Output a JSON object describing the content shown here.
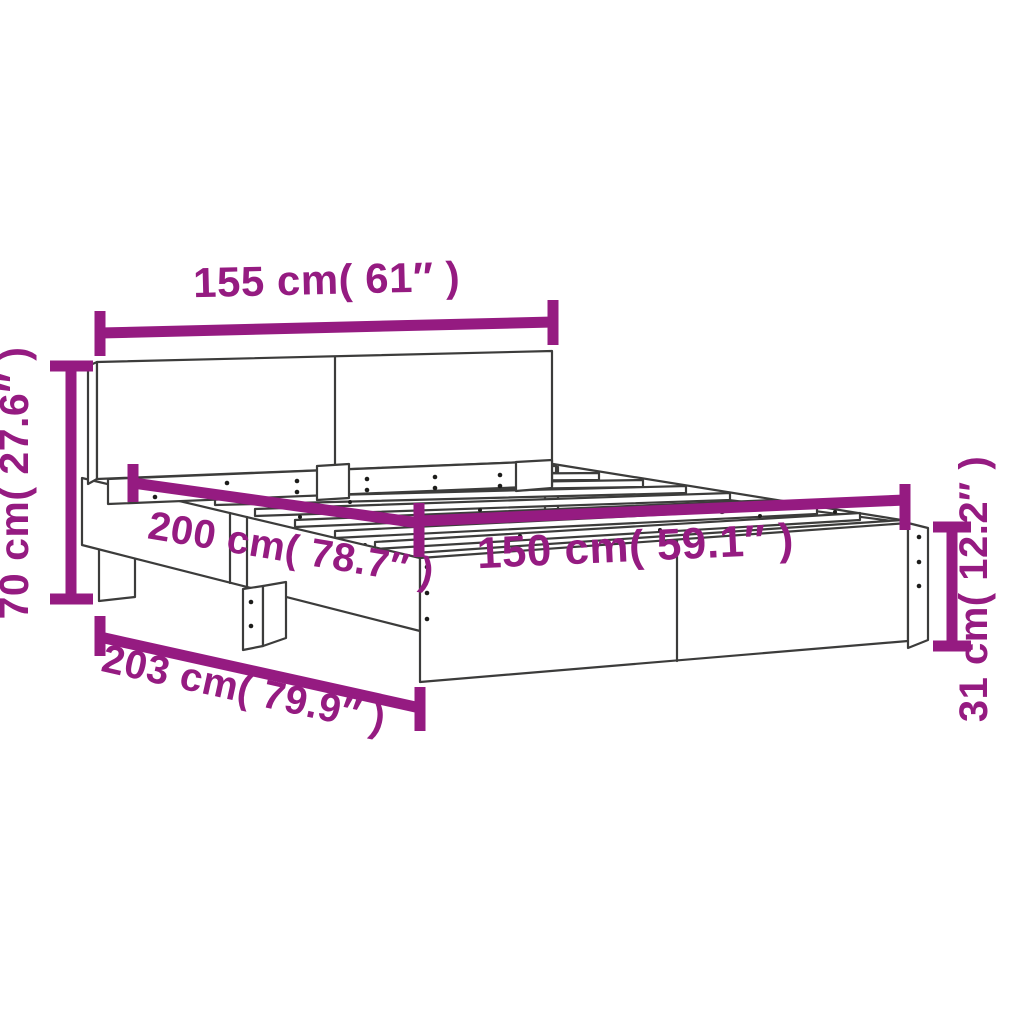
{
  "diagram": {
    "type": "product-dimension-diagram",
    "subject": "bed-frame-with-headboard",
    "background": "#FFFFFF",
    "accent_color": "#951B81",
    "line_color": "#3C3C3B",
    "dimensions": [
      {
        "id": "headboard-width",
        "label": "155 cm( 61″ )"
      },
      {
        "id": "headboard-height",
        "label": "70 cm( 27.6″ )"
      },
      {
        "id": "inner-length",
        "label": "200 cm( 78.7″ )"
      },
      {
        "id": "inner-width",
        "label": "150 cm( 59.1″ )"
      },
      {
        "id": "outer-length",
        "label": "203 cm( 79.9″ )"
      },
      {
        "id": "frame-height",
        "label": "31 cm( 12.2″ )"
      }
    ]
  }
}
